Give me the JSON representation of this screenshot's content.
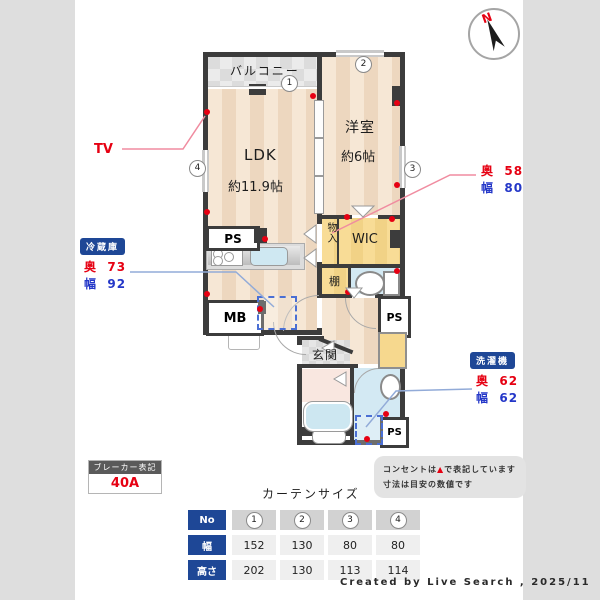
{
  "header": {
    "compass_n": "N"
  },
  "plan": {
    "rooms": {
      "balcony": "バルコニー",
      "ldk_name": "LDK",
      "ldk_size": "約11.9帖",
      "western_name": "洋室",
      "western_size": "約6帖",
      "wic": "WIC",
      "storage": "物入",
      "shelf": "棚",
      "entrance": "玄関",
      "ps": "PS",
      "mb": "MB"
    },
    "markers": {
      "m1": "1",
      "m2": "2",
      "m3": "3",
      "m4": "4"
    }
  },
  "callouts": {
    "tv": "TV",
    "fridge": {
      "title": "冷蔵庫",
      "d_label": "奥",
      "d": "73",
      "w_label": "幅",
      "w": "92"
    },
    "storage_dims": {
      "d_label": "奥",
      "d": "58",
      "w_label": "幅",
      "w": "80"
    },
    "washer": {
      "title": "洗濯機",
      "d_label": "奥",
      "d": "62",
      "w_label": "幅",
      "w": "62"
    }
  },
  "breaker": {
    "title": "ブレーカー表記",
    "value": "40A"
  },
  "notes": {
    "line1_a": "コンセントは",
    "line1_marker": "▲",
    "line1_b": "で表記しています",
    "line2": "寸法は目安の数値です"
  },
  "curtain_table": {
    "title": "カーテンサイズ",
    "rows": [
      "No",
      "幅",
      "高さ"
    ],
    "cols": [
      "1",
      "2",
      "3",
      "4"
    ],
    "width_values": [
      "152",
      "130",
      "80",
      "80"
    ],
    "height_values": [
      "202",
      "130",
      "113",
      "114"
    ]
  },
  "credit": "Created by Live Search , 2025/11",
  "colors": {
    "accent_blue": "#1e4796",
    "red": "#e60012",
    "value_blue": "#2437c8",
    "wall": "#3c3c3c"
  }
}
